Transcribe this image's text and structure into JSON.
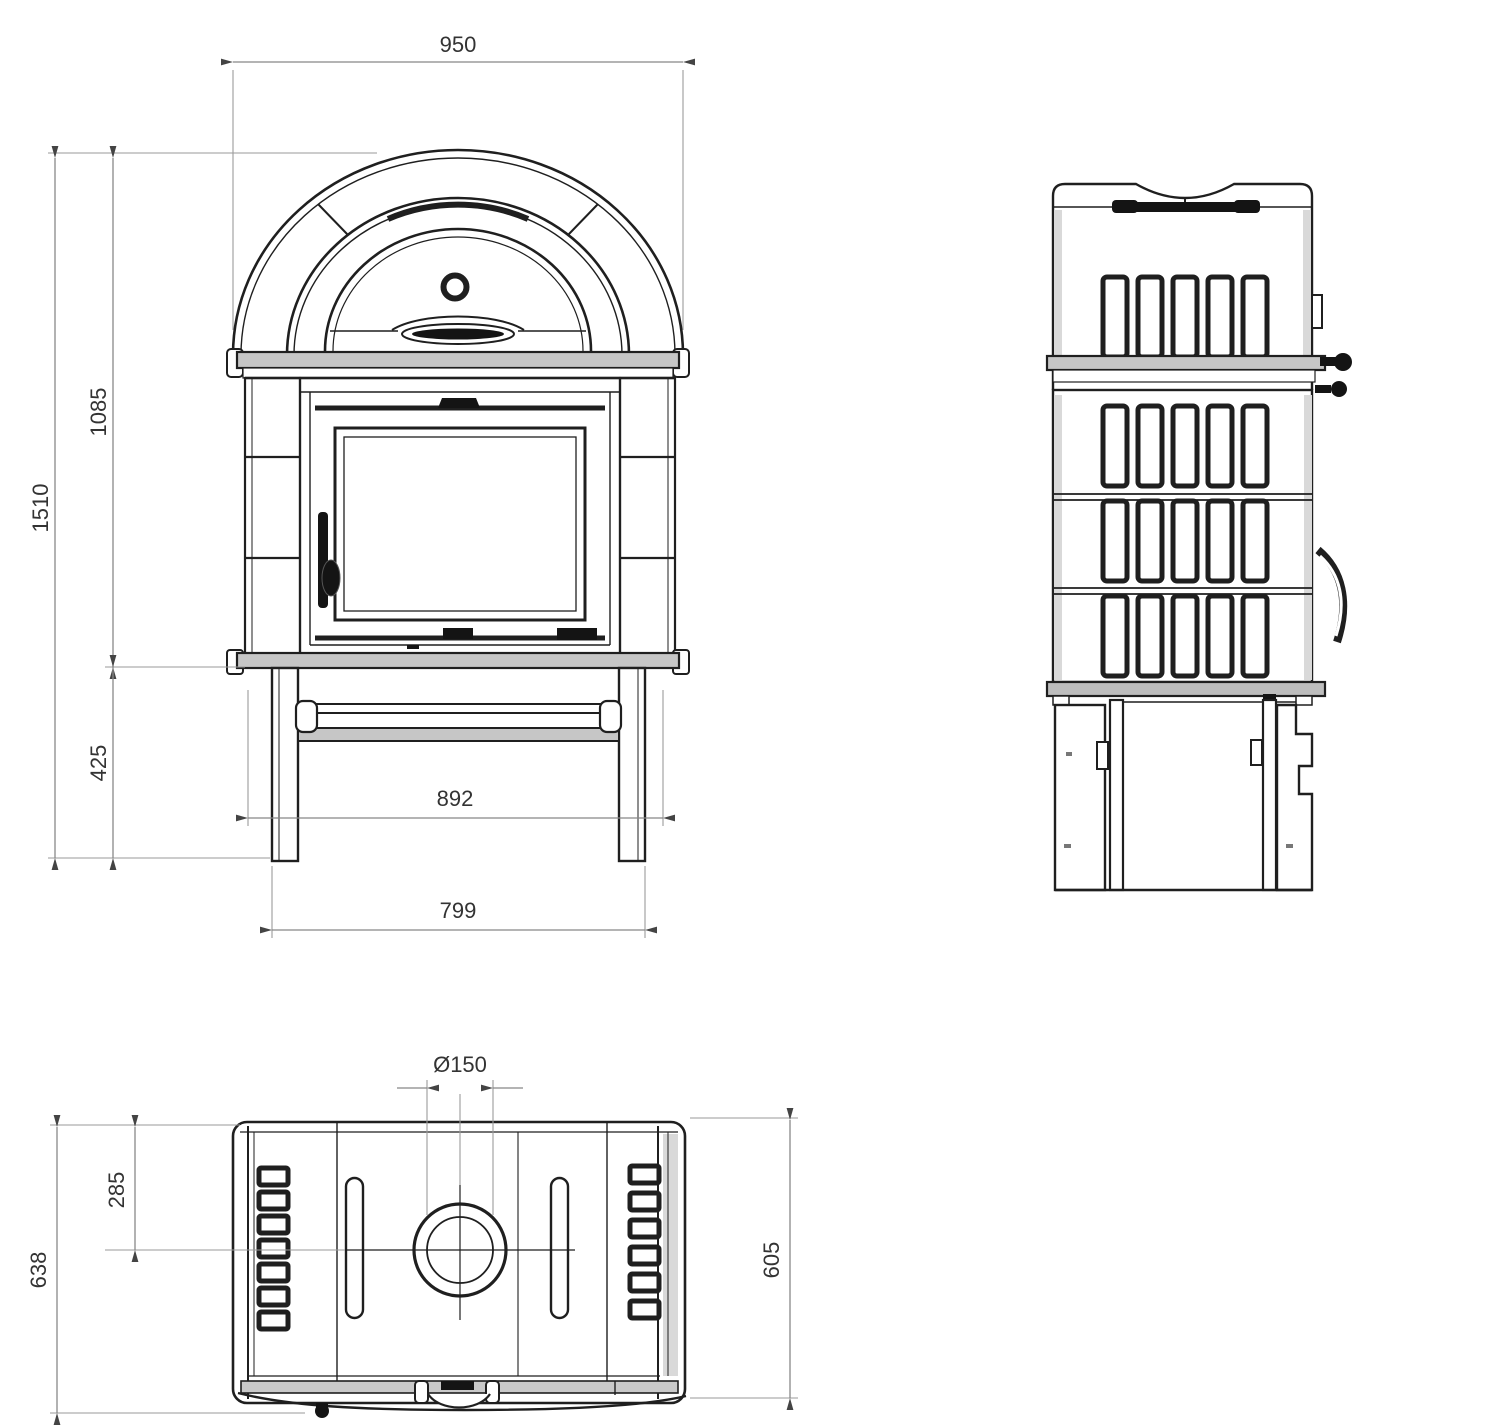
{
  "drawing": {
    "background_color": "#ffffff",
    "object_line_color": "#1f1f1f",
    "dimension_line_color": "#888888",
    "dimension_text_color": "#333333"
  },
  "dimensions": {
    "overall_width": "950",
    "body_height": "1085",
    "overall_height": "1510",
    "base_height": "425",
    "base_shelf_width": "892",
    "leg_span_width": "799",
    "flue_diameter": "Ø150",
    "flue_center_offset": "285",
    "overall_depth": "638",
    "top_plate_depth": "605"
  }
}
